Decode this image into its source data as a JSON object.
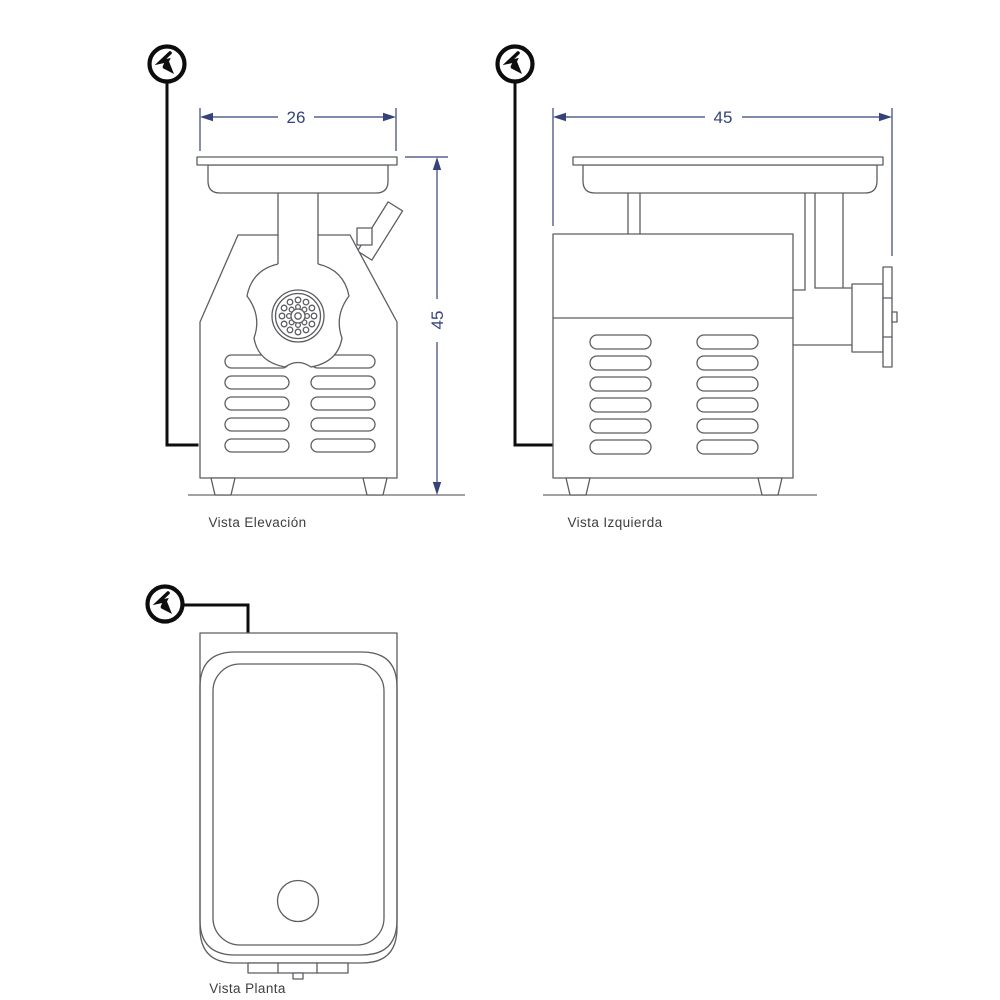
{
  "document": {
    "type": "technical-drawing",
    "subject": "meat-grinder orthographic views",
    "background": "#ffffff"
  },
  "views": {
    "elevation": {
      "label": "Vista Elevación"
    },
    "left": {
      "label": "Vista Izquierda"
    },
    "plan": {
      "label": "Vista Planta"
    }
  },
  "dimensions": {
    "elevation_width": "26",
    "elevation_height": "45",
    "left_width": "45"
  },
  "icons": {
    "power_symbol": "electric-supply-lightning-icon"
  },
  "colors": {
    "drawing_line": "#5d5e62",
    "dimension": "#36437a",
    "power_line": "#0d0d0d",
    "label_text": "#3e3e42"
  }
}
